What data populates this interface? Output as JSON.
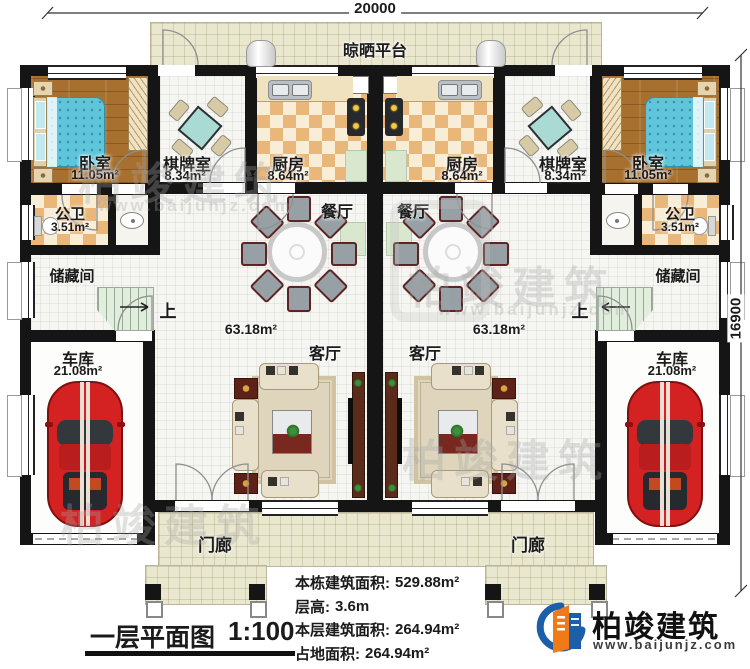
{
  "header": {
    "top_dimension": "20000",
    "right_dimension": "16900"
  },
  "platform": {
    "label": "晾晒平台"
  },
  "rooms": {
    "bedroom": {
      "name": "卧室",
      "area": "11.05m²"
    },
    "game_room": {
      "name": "棋牌室",
      "area": "8.34m²"
    },
    "kitchen": {
      "name": "厨房",
      "area": "8.64m²"
    },
    "dining": {
      "name": "餐厅"
    },
    "living": {
      "name": "客厅",
      "area": "63.18m²"
    },
    "bathroom": {
      "name": "公卫",
      "area": "3.51m²"
    },
    "storage": {
      "name": "储藏间"
    },
    "garage": {
      "name": "车库",
      "area": "21.08m²"
    },
    "porch": {
      "name": "门廊"
    },
    "stairs_up": "上"
  },
  "title_block": {
    "title": "一层平面图",
    "scale": "1:100"
  },
  "stats": {
    "rows": [
      {
        "label": "本栋建筑面积:",
        "value": "529.88m²"
      },
      {
        "label": "层高:",
        "value": "3.6m"
      },
      {
        "label": "本层建筑面积:",
        "value": "264.94m²"
      },
      {
        "label": "占地面积:",
        "value": "264.94m²"
      }
    ]
  },
  "brand": {
    "company": "柏竣建筑",
    "website": "www.baijunjz.com"
  },
  "watermark": {
    "text": "柏竣建筑",
    "subtext": "www.baijunjz.com"
  },
  "colors": {
    "wall": "#151515",
    "brand_blue": "#1c5fa8",
    "brand_orange": "#f07a18",
    "car_red": "#d42222"
  }
}
